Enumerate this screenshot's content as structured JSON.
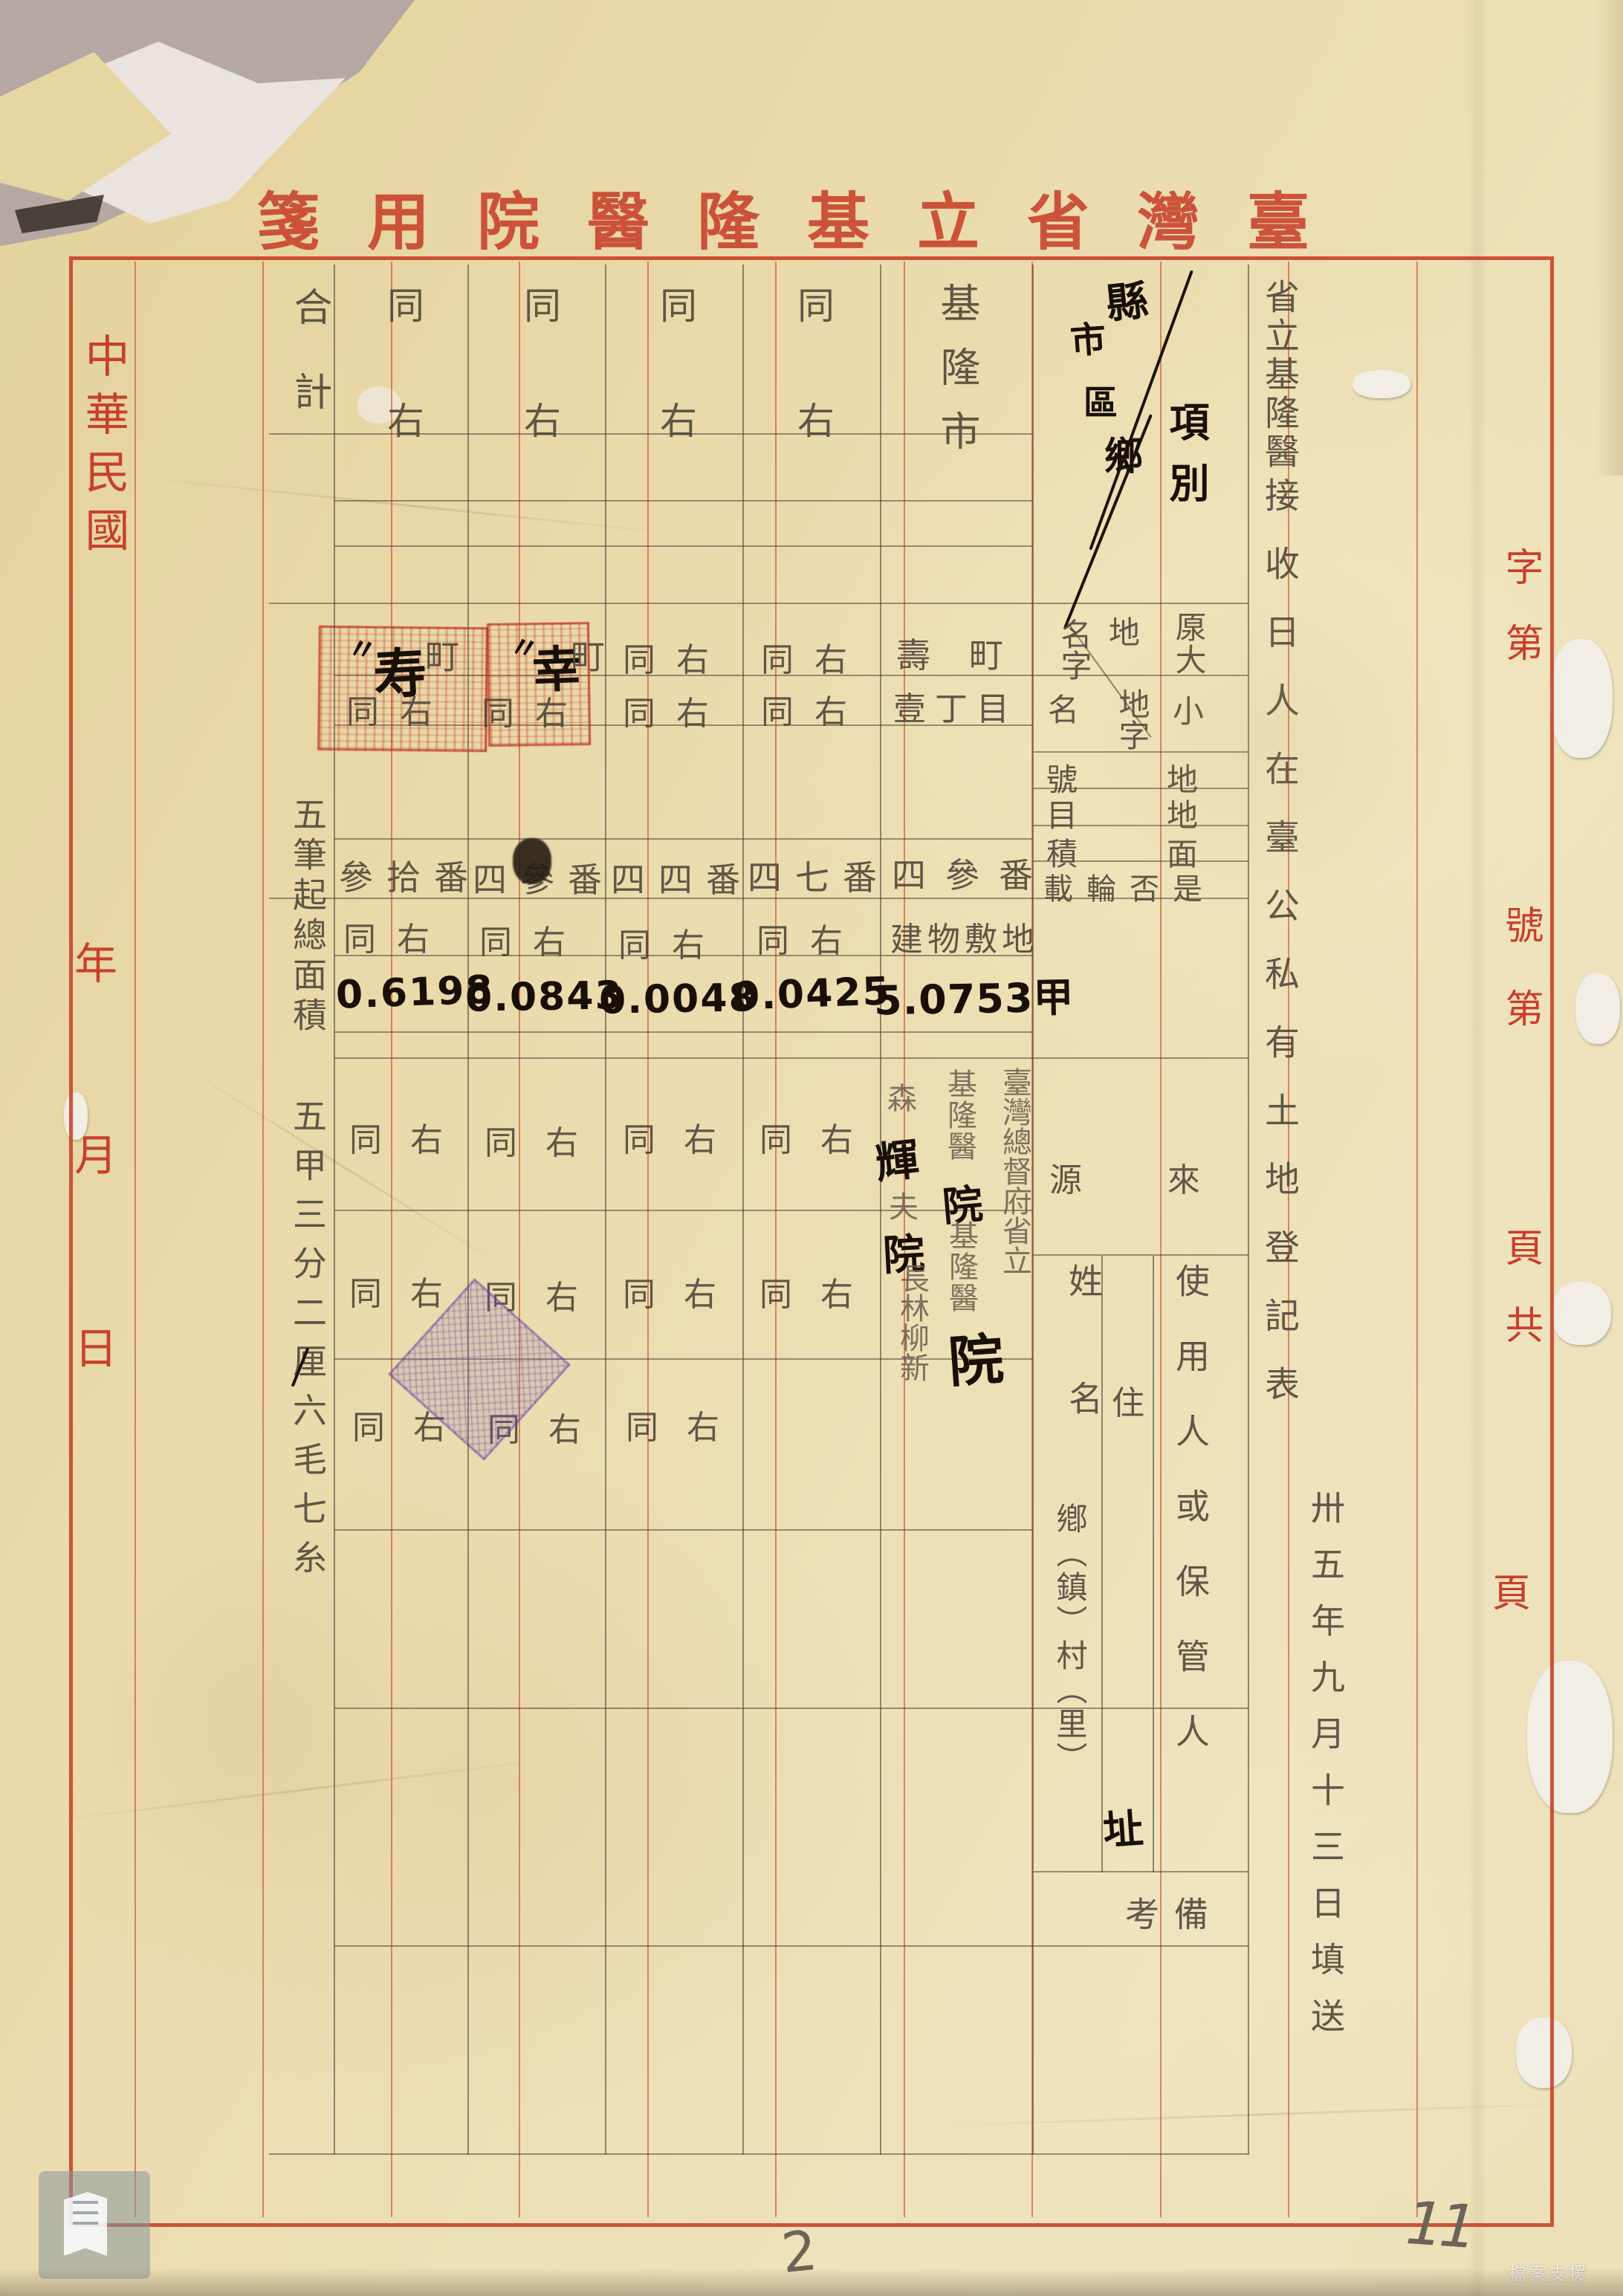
{
  "colors": {
    "paper": "#e9d9a8",
    "print_red": "#c8402a",
    "pencil": "#51483c",
    "ink": "#181007",
    "stamp_red": "#ba2c1b",
    "stamp_purple": "#7a58ba"
  },
  "stationery": {
    "header_title": "箋用院醫隆基立省灣臺",
    "left_margin": {
      "era": "中華民國",
      "year": "年",
      "month": "月",
      "day": "日"
    },
    "right_margin": {
      "g1": "字第",
      "g2": "號第",
      "g3": "頁共",
      "g4": "頁"
    }
  },
  "doc": {
    "agency": "省立基隆醫",
    "form_title": "接收日人在臺公私有土地登記表",
    "filed_date": "卅五年九月十三日填送"
  },
  "corner": {
    "r1": "縣",
    "r2": "市",
    "r3": "區",
    "r4": "鄉",
    "label": "項別"
  },
  "labels": {
    "landname_a_right": "厡大",
    "landname_a_mid": "地",
    "landname_a_left": "名字",
    "landname_b_right": "小",
    "landname_b_mid": "地字",
    "landname_b_left": "名",
    "lot": "地號",
    "category": "地目",
    "area": "面積",
    "rotation": "是否輪載",
    "source": "來源",
    "user": "使用人或保管人",
    "name": "姓名",
    "address": "住",
    "address_ink": "址",
    "address_units": "鄕（鎮）村（里）",
    "remark": "備考"
  },
  "ditto": "同右",
  "entries": {
    "col1": {
      "county": "基隆市",
      "oaza": "壽町",
      "koaza": "壹丁目",
      "lot": "四參番",
      "category": "建物敷地",
      "area": "5.0753甲",
      "src1": "臺灣總督府省立",
      "src2": "基隆醫",
      "src2_ink": "院",
      "name1": "基隆醫",
      "name1_ink": "院",
      "name2a": "森",
      "name2_ink1": "輝",
      "name2b": "夫",
      "name2_ink2": "院",
      "name2c": "長林柳新",
      "seal_ink": "院"
    },
    "col2": {
      "lot": "四七番",
      "area": "0.0425"
    },
    "col3": {
      "lot": "四四番",
      "area": "0.0048"
    },
    "col4": {
      "lot": "四參番",
      "area": "0.0843",
      "oaza_ink": "幸",
      "oaza": "町"
    },
    "col5": {
      "lot": "參拾番",
      "area": "0.6198",
      "oaza_ink": "寿",
      "oaza": "町"
    }
  },
  "total": {
    "label": "合計",
    "line1": "五筆起總面積",
    "line2": "五甲三分二厘六毛七糸"
  },
  "annotations": {
    "page_number": "2",
    "corner_number": "11",
    "watermark": "檔案支援"
  }
}
